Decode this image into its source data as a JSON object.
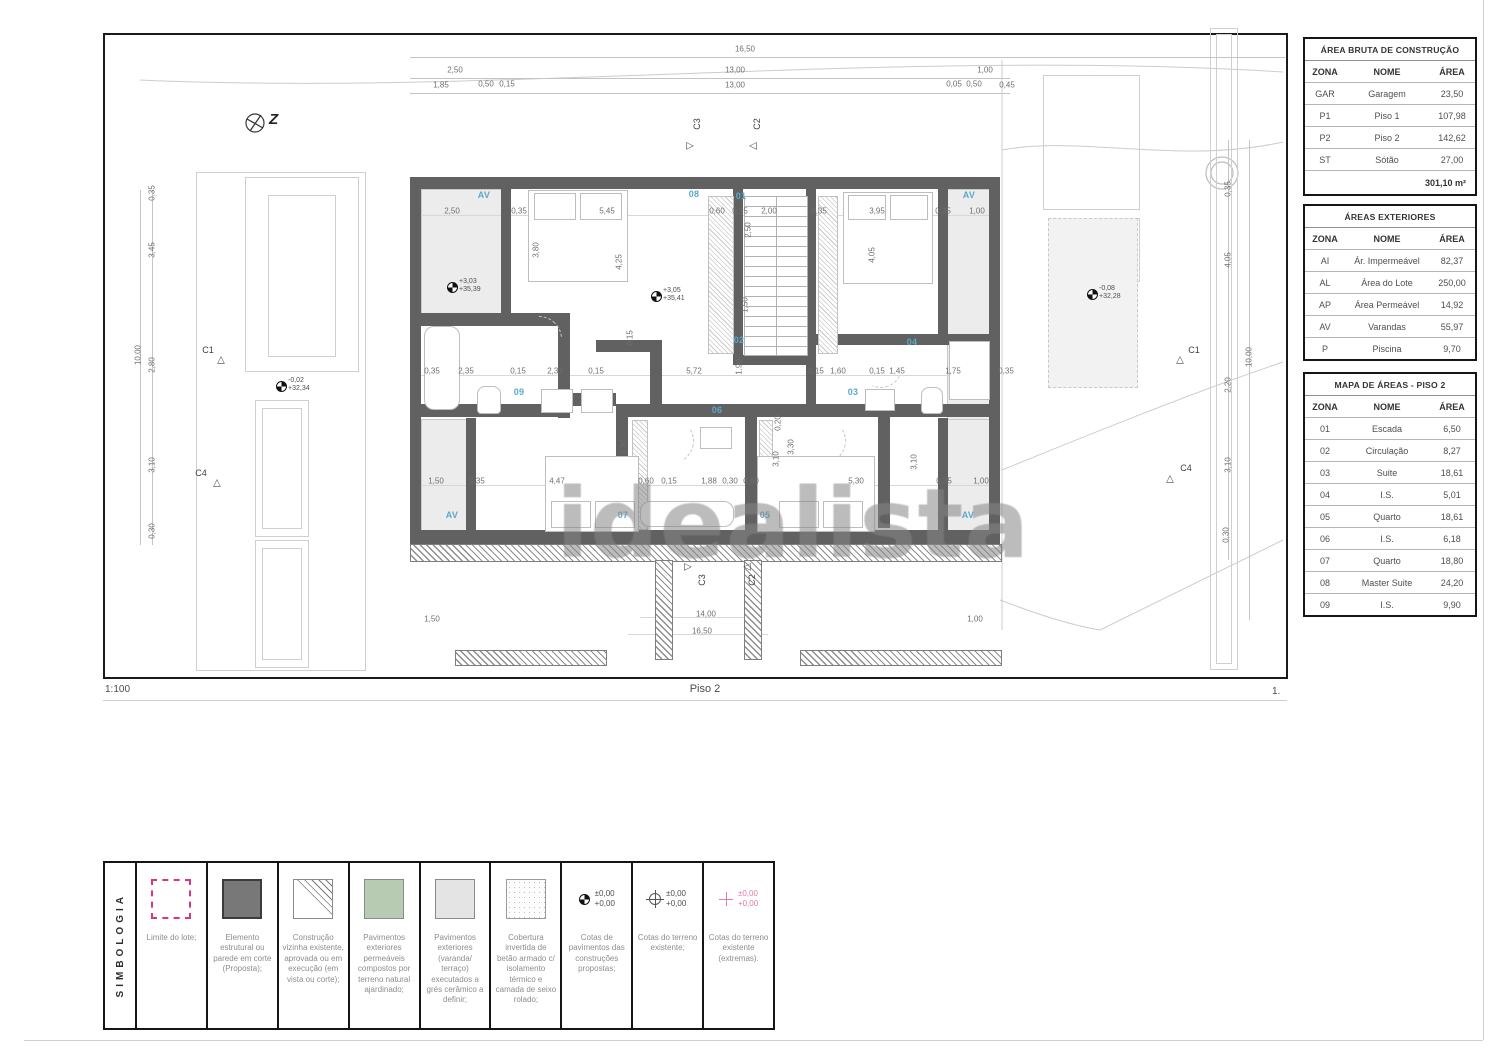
{
  "watermark": "idealista",
  "colors": {
    "wall": "#616161",
    "room_label_blue": "#58a9cc",
    "legend_pink": "#da3680",
    "balcony_gray": "#ececec",
    "table_border": "#151515"
  },
  "footer": {
    "scale": "1:100",
    "plan_title": "Piso 2",
    "page": "1."
  },
  "north_label": "Z",
  "tables": {
    "area_bruta": {
      "title": "ÁREA BRUTA DE CONSTRUÇÃO",
      "headers": [
        "ZONA",
        "NOME",
        "ÁREA"
      ],
      "rows": [
        [
          "GAR",
          "Garagem",
          "23,50"
        ],
        [
          "P1",
          "Piso 1",
          "107,98"
        ],
        [
          "P2",
          "Piso 2",
          "142,62"
        ],
        [
          "ST",
          "Sótão",
          "27,00"
        ]
      ],
      "total": "301,10 m²"
    },
    "areas_exteriores": {
      "title": "ÁREAS EXTERIORES",
      "headers": [
        "ZONA",
        "NOME",
        "ÁREA"
      ],
      "rows": [
        [
          "AI",
          "Ár. Impermeável",
          "82,37"
        ],
        [
          "AL",
          "Área do Lote",
          "250,00"
        ],
        [
          "AP",
          "Área Permeável",
          "14,92"
        ],
        [
          "AV",
          "Varandas",
          "55,97"
        ],
        [
          "P",
          "Piscina",
          "9,70"
        ]
      ]
    },
    "mapa_areas": {
      "title": "MAPA DE ÁREAS - PISO 2",
      "headers": [
        "ZONA",
        "NOME",
        "ÁREA"
      ],
      "rows": [
        [
          "01",
          "Escada",
          "6,50"
        ],
        [
          "02",
          "Circulação",
          "8,27"
        ],
        [
          "03",
          "Suite",
          "18,61"
        ],
        [
          "04",
          "I.S.",
          "5,01"
        ],
        [
          "05",
          "Quarto",
          "18,61"
        ],
        [
          "06",
          "I.S.",
          "6,18"
        ],
        [
          "07",
          "Quarto",
          "18,80"
        ],
        [
          "08",
          "Master Suite",
          "24,20"
        ],
        [
          "09",
          "I.S.",
          "9,90"
        ]
      ]
    }
  },
  "legend": {
    "title": "SIMBOLOGIA",
    "cote_values": [
      "±0,00",
      "+0,00"
    ],
    "items": [
      {
        "type": "lot",
        "label": "Limite do lote;"
      },
      {
        "type": "dark",
        "label": "Elemento estrutural ou parede em corte (Proposta);"
      },
      {
        "type": "tri-h",
        "label": "Construção vizinha existente, aprovada ou em execução (em vista ou corte);"
      },
      {
        "type": "green",
        "label": "Pavimentos exteriores permeáveis compostos por terreno natural ajardinado;"
      },
      {
        "type": "lgray",
        "label": "Pavimentos exteriores (varanda/ terraço) executados a grés cerâmico a definir;"
      },
      {
        "type": "stip",
        "label": "Cobertura invertida de betão armado c/ isolamento térmico e camada de seixo rolado;"
      },
      {
        "type": "cote-filled",
        "label": "Cotas de pavimentos das construções propostas;"
      },
      {
        "type": "cote-open",
        "label": "Cotas do terreno existente;"
      },
      {
        "type": "cote-pink",
        "label": "Cotas do terreno existente (extremas)."
      }
    ]
  },
  "plan": {
    "room_labels": [
      {
        "t": "01",
        "x": 741,
        "y": 196
      },
      {
        "t": "02",
        "x": 739,
        "y": 340
      },
      {
        "t": "03",
        "x": 853,
        "y": 392
      },
      {
        "t": "04",
        "x": 912,
        "y": 342
      },
      {
        "t": "05",
        "x": 765,
        "y": 515
      },
      {
        "t": "06",
        "x": 717,
        "y": 410
      },
      {
        "t": "07",
        "x": 623,
        "y": 515
      },
      {
        "t": "08",
        "x": 694,
        "y": 194
      },
      {
        "t": "09",
        "x": 519,
        "y": 392
      }
    ],
    "balcony_labels": [
      {
        "t": "AV",
        "x": 484,
        "y": 195
      },
      {
        "t": "AV",
        "x": 969,
        "y": 195
      },
      {
        "t": "AV",
        "x": 452,
        "y": 515
      },
      {
        "t": "AV",
        "x": 968,
        "y": 515
      }
    ],
    "dimensions": [
      {
        "t": "16,50",
        "x": 745,
        "y": 49
      },
      {
        "t": "2,50",
        "x": 455,
        "y": 70
      },
      {
        "t": "13,00",
        "x": 735,
        "y": 70
      },
      {
        "t": "1,00",
        "x": 985,
        "y": 70
      },
      {
        "t": "1,85",
        "x": 441,
        "y": 85
      },
      {
        "t": "0,50",
        "x": 486,
        "y": 84
      },
      {
        "t": "0,15",
        "x": 507,
        "y": 84
      },
      {
        "t": "13,00",
        "x": 735,
        "y": 85
      },
      {
        "t": "0,05",
        "x": 954,
        "y": 84
      },
      {
        "t": "0,50",
        "x": 974,
        "y": 84
      },
      {
        "t": "0,45",
        "x": 1007,
        "y": 85
      },
      {
        "t": "2,50",
        "x": 452,
        "y": 211
      },
      {
        "t": "0,35",
        "x": 519,
        "y": 211
      },
      {
        "t": "5,45",
        "x": 607,
        "y": 211
      },
      {
        "t": "0,60",
        "x": 717,
        "y": 211
      },
      {
        "t": "0,15",
        "x": 740,
        "y": 211
      },
      {
        "t": "2,00",
        "x": 769,
        "y": 211
      },
      {
        "t": "0,35",
        "x": 819,
        "y": 211
      },
      {
        "t": "3,95",
        "x": 877,
        "y": 211
      },
      {
        "t": "0,35",
        "x": 943,
        "y": 211
      },
      {
        "t": "1,00",
        "x": 977,
        "y": 211
      },
      {
        "t": "0,35",
        "x": 432,
        "y": 371
      },
      {
        "t": "2,35",
        "x": 466,
        "y": 371
      },
      {
        "t": "0,15",
        "x": 518,
        "y": 371
      },
      {
        "t": "2,33",
        "x": 555,
        "y": 371
      },
      {
        "t": "0,15",
        "x": 596,
        "y": 371
      },
      {
        "t": "5,72",
        "x": 694,
        "y": 371
      },
      {
        "t": "0,15",
        "x": 816,
        "y": 371
      },
      {
        "t": "1,60",
        "x": 838,
        "y": 371
      },
      {
        "t": "0,15",
        "x": 877,
        "y": 371
      },
      {
        "t": "1,45",
        "x": 897,
        "y": 371
      },
      {
        "t": "1,75",
        "x": 953,
        "y": 371
      },
      {
        "t": "0,35",
        "x": 1006,
        "y": 371
      },
      {
        "t": "1,50",
        "x": 436,
        "y": 481
      },
      {
        "t": "0,35",
        "x": 477,
        "y": 481
      },
      {
        "t": "4,47",
        "x": 557,
        "y": 481
      },
      {
        "t": "0,60",
        "x": 646,
        "y": 481
      },
      {
        "t": "0,15",
        "x": 669,
        "y": 481
      },
      {
        "t": "1,88",
        "x": 709,
        "y": 481
      },
      {
        "t": "0,30",
        "x": 730,
        "y": 481
      },
      {
        "t": "0,60",
        "x": 751,
        "y": 481
      },
      {
        "t": "5,30",
        "x": 856,
        "y": 481
      },
      {
        "t": "0,35",
        "x": 944,
        "y": 481
      },
      {
        "t": "1,00",
        "x": 981,
        "y": 481
      },
      {
        "t": "3,80",
        "x": 536,
        "y": 250,
        "r": 1
      },
      {
        "t": "4,25",
        "x": 619,
        "y": 262,
        "r": 1
      },
      {
        "t": "2,50",
        "x": 748,
        "y": 230,
        "r": 1
      },
      {
        "t": "1,50",
        "x": 745,
        "y": 305,
        "r": 1
      },
      {
        "t": "4,05",
        "x": 872,
        "y": 255,
        "r": 1
      },
      {
        "t": "0,15",
        "x": 630,
        "y": 338,
        "r": 1
      },
      {
        "t": "1,90",
        "x": 739,
        "y": 367,
        "r": 1
      },
      {
        "t": "3,30",
        "x": 624,
        "y": 447,
        "r": 1
      },
      {
        "t": "3,30",
        "x": 791,
        "y": 447,
        "r": 1
      },
      {
        "t": "3,10",
        "x": 776,
        "y": 459,
        "r": 1
      },
      {
        "t": "3,10",
        "x": 914,
        "y": 462,
        "r": 1
      },
      {
        "t": "0,20",
        "x": 778,
        "y": 423,
        "r": 1
      },
      {
        "t": "0,35",
        "x": 152,
        "y": 193,
        "r": 1
      },
      {
        "t": "3,45",
        "x": 152,
        "y": 250,
        "r": 1
      },
      {
        "t": "10,00",
        "x": 138,
        "y": 355,
        "r": 1
      },
      {
        "t": "2,80",
        "x": 152,
        "y": 365,
        "r": 1
      },
      {
        "t": "3,10",
        "x": 152,
        "y": 465,
        "r": 1
      },
      {
        "t": "0,30",
        "x": 152,
        "y": 531,
        "r": 1
      },
      {
        "t": "0,35",
        "x": 1228,
        "y": 189,
        "r": 1
      },
      {
        "t": "4,05",
        "x": 1228,
        "y": 260,
        "r": 1
      },
      {
        "t": "10,00",
        "x": 1249,
        "y": 357,
        "r": 1
      },
      {
        "t": "2,20",
        "x": 1228,
        "y": 385,
        "r": 1
      },
      {
        "t": "3,10",
        "x": 1228,
        "y": 465,
        "r": 1
      },
      {
        "t": "0,30",
        "x": 1226,
        "y": 535,
        "r": 1
      },
      {
        "t": "14,00",
        "x": 706,
        "y": 614
      },
      {
        "t": "16,50",
        "x": 702,
        "y": 631
      },
      {
        "t": "1,00",
        "x": 975,
        "y": 619
      },
      {
        "t": "1,50",
        "x": 432,
        "y": 619
      }
    ],
    "elevations": [
      {
        "l1": "-0,02",
        "l2": "+32,34",
        "x": 288,
        "y": 380
      },
      {
        "l1": "+3,03",
        "l2": "+35,39",
        "x": 459,
        "y": 281
      },
      {
        "l1": "+3,05",
        "l2": "+35,41",
        "x": 663,
        "y": 290
      },
      {
        "l1": "-0,08",
        "l2": "+32,28",
        "x": 1099,
        "y": 288
      }
    ],
    "section_markers": [
      {
        "t": "C3",
        "x": 697,
        "y": 124,
        "r": 1,
        "tri": "▷",
        "tx": 690,
        "ty": 146
      },
      {
        "t": "C2",
        "x": 757,
        "y": 124,
        "r": 1,
        "tri": "◁",
        "tx": 753,
        "ty": 146
      },
      {
        "t": "C3",
        "x": 702,
        "y": 580,
        "r": 1,
        "tri": "▷",
        "tx": 688,
        "ty": 567
      },
      {
        "t": "C2",
        "x": 752,
        "y": 580,
        "r": 1,
        "tri": "◁",
        "tx": 747,
        "ty": 567
      },
      {
        "t": "C1",
        "x": 208,
        "y": 350,
        "tri": "△",
        "tx": 221,
        "ty": 360
      },
      {
        "t": "C4",
        "x": 201,
        "y": 473,
        "tri": "△",
        "tx": 217,
        "ty": 483
      },
      {
        "t": "C1",
        "x": 1194,
        "y": 350,
        "tri": "△",
        "tx": 1180,
        "ty": 360
      },
      {
        "t": "C4",
        "x": 1186,
        "y": 468,
        "tri": "△",
        "tx": 1170,
        "ty": 479
      }
    ]
  }
}
